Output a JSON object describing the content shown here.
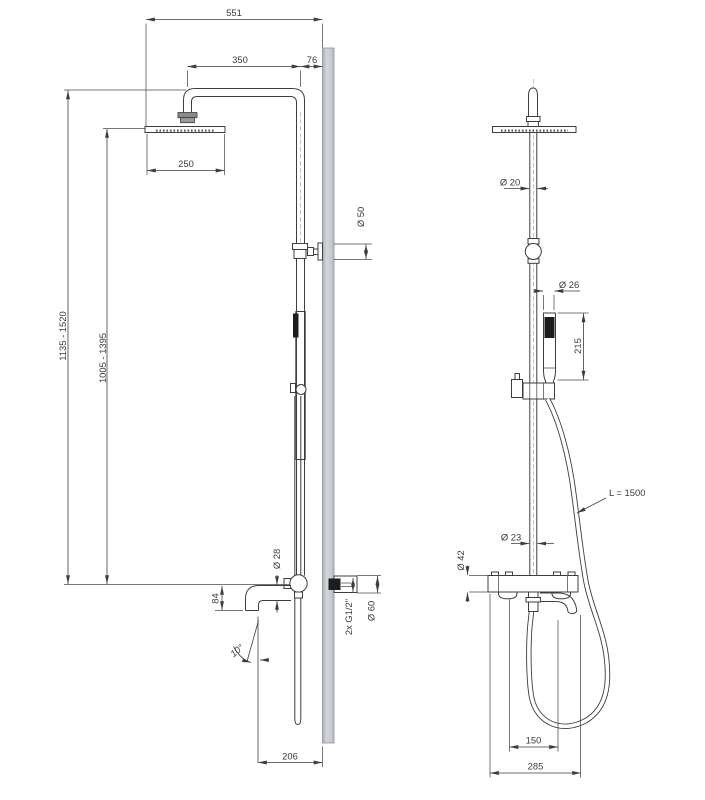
{
  "drawing": {
    "colors": {
      "line": "#3d3d3d",
      "wall_fill": "#c9cdd3",
      "wall_edge": "#8f959c",
      "dark_fill": "#1d1d1d",
      "background": "#ffffff"
    },
    "dimensions": {
      "top_width": "551",
      "arm_reach": "350",
      "wall_offset": "76",
      "head_diameter": "250",
      "height_range_max": "1135 - 1520",
      "height_range_min": "1005 - 1395",
      "bracket_diameter": "Ø 50",
      "spout_diameter": "Ø 28",
      "spout_drop": "84",
      "spout_angle": "10°",
      "connections": "2x G1/2\"",
      "escutcheon_diameter": "Ø 60",
      "spout_reach": "206",
      "pipe_diameter": "Ø 20",
      "handshower_diameter": "Ø 26",
      "handshower_length": "215",
      "hose_length": "L = 1500",
      "riser_diameter": "Ø 23",
      "valve_diameter": "Ø 42",
      "valve_centers": "150",
      "valve_width": "285"
    }
  }
}
